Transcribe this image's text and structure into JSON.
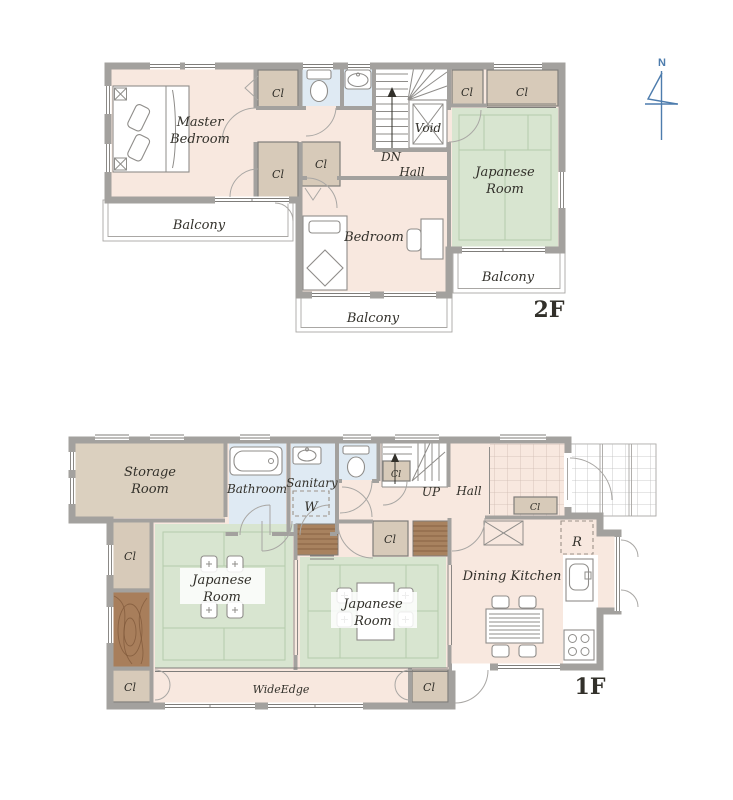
{
  "palette": {
    "floor": "#f8e8df",
    "tatami": "#d8e5d0",
    "tatami_line": "#b5cbab",
    "closet": "#d7cab9",
    "storage": "#dbd0bf",
    "water": "#dfeaf3",
    "wall": "#a3a19e",
    "wall_dark": "#7f7d7a",
    "louver": "#a8825f",
    "wood": "#a87e5b",
    "wood_dark": "#7c5637",
    "line": "#8f8d8a",
    "thin_line": "#a9a7a4",
    "genkan_line": "#cfbcb2",
    "porch_line": "#bcbcbc",
    "ink": "#32302a",
    "compass": "#4d7cad",
    "dash": "#9c9288"
  },
  "compass": {
    "north": "N"
  },
  "floor2": {
    "label": "2F",
    "master_bedroom": [
      "Master",
      "Bedroom"
    ],
    "bedroom": "Bedroom",
    "japanese_room": [
      "Japanese",
      "Room"
    ],
    "hall": "Hall",
    "down": "DN",
    "void": "Void",
    "closet": "Cl",
    "balcony": "Balcony"
  },
  "floor1": {
    "label": "1F",
    "storage_room": [
      "Storage",
      "Room"
    ],
    "bathroom": "Bathroom",
    "sanitary": "Sanitary",
    "washer": "W",
    "up": "UP",
    "hall": "Hall",
    "closet": "Cl",
    "refrigerator": "R",
    "dining_kitchen": "Dining Kitchen",
    "japanese_room": [
      "Japanese",
      "Room"
    ],
    "wide_edge": "WideEdge"
  }
}
